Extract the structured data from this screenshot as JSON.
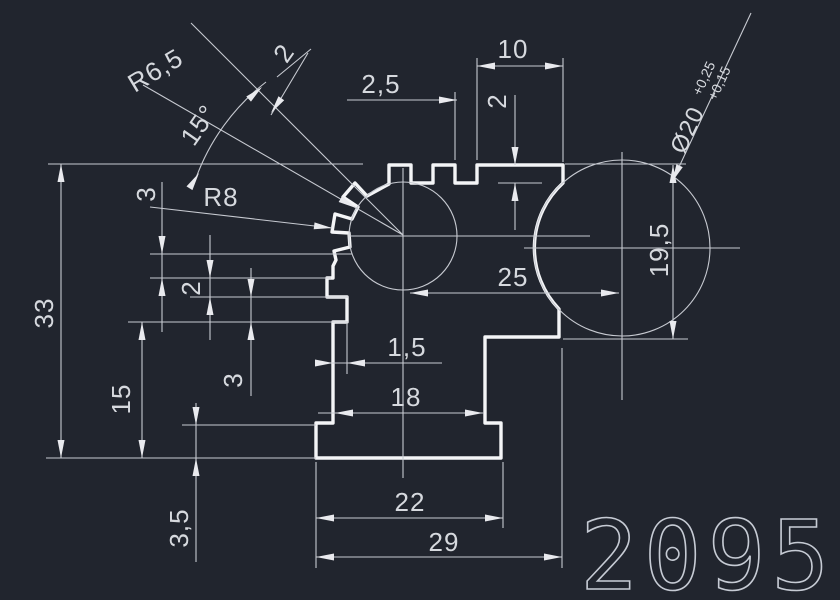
{
  "drawing_number": "2095",
  "colors": {
    "background": "#21252e",
    "profile_line": "#f4f5f7",
    "thin_line": "#c7cad1",
    "text": "#d6d9de"
  },
  "dims": {
    "top_width": "10",
    "slot_width": "2,5",
    "tooth_depth": "2",
    "bore_dia": "Ø20",
    "bore_tol_upper": "+0,25",
    "bore_tol_lower": "+0,15",
    "right_height": "19,5",
    "center_dist": "25",
    "tip_radius": "R8",
    "root_radius": "R6,5",
    "tooth_angle": "15°",
    "tooth_width": "2",
    "step_a": "3",
    "rib_height": "2",
    "groove_height": "3",
    "total_height": "33",
    "lower_height": "15",
    "groove_depth": "1,5",
    "mid_width": "18",
    "base_thickness": "3,5",
    "base_width": "22",
    "total_width": "29"
  }
}
